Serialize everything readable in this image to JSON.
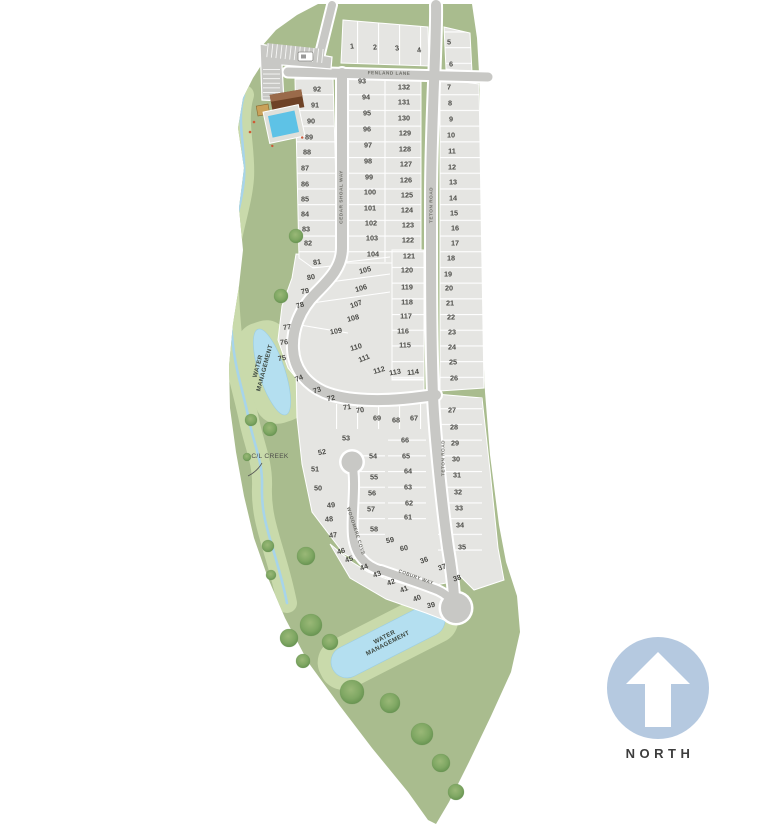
{
  "colors": {
    "land": "#a9bc8e",
    "land_light": "#c9daab",
    "lot": "#e5e5e2",
    "road": "#c8c8c5",
    "water": "#b4dff0",
    "pool": "#5ec2e6",
    "tree": "#7fa763",
    "north_badge": "#b5c9e0",
    "text_dark": "#4b4b47",
    "text_mid": "#6e6e68",
    "clubhouse": "#6e4226"
  },
  "north": {
    "label": "NORTH"
  },
  "map": {
    "streets": [
      {
        "name": "FENLAND LANE",
        "x": 389,
        "y": 73,
        "rot": 1
      },
      {
        "name": "CEDAR SHOAL WAY",
        "x": 341,
        "y": 197,
        "rot": -90
      },
      {
        "name": "TETON ROAD",
        "x": 431,
        "y": 205,
        "rot": -90
      },
      {
        "name": "TETON ROAD",
        "x": 443,
        "y": 458,
        "rot": -90
      },
      {
        "name": "WOODMERE COVE",
        "x": 356,
        "y": 531,
        "rot": 72
      },
      {
        "name": "COBURY WAY",
        "x": 416,
        "y": 577,
        "rot": 20
      }
    ],
    "water_labels": [
      {
        "line1": "WATER",
        "line2": "MANAGEMENT",
        "x": 261,
        "y": 367,
        "rot": -75
      },
      {
        "line1": "WATER",
        "line2": "MANAGEMENT",
        "x": 386,
        "y": 640,
        "rot": -27
      }
    ],
    "creek_label": {
      "name": "C/L CREEK",
      "x": 270,
      "y": 458
    },
    "lots": [
      [
        1,
        352,
        46,
        -6
      ],
      [
        2,
        375,
        47,
        -6
      ],
      [
        3,
        397,
        48,
        -8
      ],
      [
        4,
        419,
        50,
        -8
      ],
      [
        5,
        449,
        42
      ],
      [
        6,
        451,
        64
      ],
      [
        7,
        449,
        87
      ],
      [
        8,
        450,
        103
      ],
      [
        9,
        451,
        119
      ],
      [
        10,
        451,
        135
      ],
      [
        11,
        452,
        151
      ],
      [
        12,
        452,
        167
      ],
      [
        13,
        453,
        182
      ],
      [
        14,
        453,
        198
      ],
      [
        15,
        454,
        213
      ],
      [
        16,
        455,
        228
      ],
      [
        17,
        455,
        243
      ],
      [
        18,
        451,
        258
      ],
      [
        19,
        448,
        274
      ],
      [
        20,
        449,
        288
      ],
      [
        21,
        450,
        303
      ],
      [
        22,
        451,
        317
      ],
      [
        23,
        452,
        332
      ],
      [
        24,
        452,
        347
      ],
      [
        25,
        453,
        362
      ],
      [
        26,
        454,
        378
      ],
      [
        27,
        452,
        410
      ],
      [
        28,
        454,
        427
      ],
      [
        29,
        455,
        443
      ],
      [
        30,
        456,
        459
      ],
      [
        31,
        457,
        475
      ],
      [
        32,
        458,
        492
      ],
      [
        33,
        459,
        508
      ],
      [
        34,
        460,
        525
      ],
      [
        35,
        462,
        547
      ],
      [
        36,
        424,
        560,
        -20
      ],
      [
        37,
        442,
        567,
        -20
      ],
      [
        38,
        457,
        578,
        -18
      ],
      [
        39,
        431,
        605,
        -12
      ],
      [
        40,
        417,
        598,
        -22
      ],
      [
        41,
        404,
        589,
        -22
      ],
      [
        42,
        391,
        582,
        -20
      ],
      [
        43,
        377,
        574,
        -20
      ],
      [
        44,
        364,
        567,
        -20
      ],
      [
        45,
        349,
        559,
        -20
      ],
      [
        46,
        341,
        551,
        -15
      ],
      [
        47,
        333,
        535,
        -8
      ],
      [
        48,
        329,
        519,
        -5
      ],
      [
        49,
        331,
        505,
        -5
      ],
      [
        50,
        318,
        488
      ],
      [
        51,
        315,
        469
      ],
      [
        52,
        322,
        452,
        -10
      ],
      [
        53,
        346,
        438
      ],
      [
        54,
        373,
        456
      ],
      [
        55,
        374,
        477
      ],
      [
        56,
        372,
        493
      ],
      [
        57,
        371,
        509
      ],
      [
        58,
        374,
        529
      ],
      [
        59,
        390,
        540,
        -12
      ],
      [
        60,
        404,
        548,
        -10
      ],
      [
        61,
        408,
        517
      ],
      [
        62,
        409,
        503
      ],
      [
        63,
        408,
        487
      ],
      [
        64,
        408,
        471
      ],
      [
        65,
        406,
        456
      ],
      [
        66,
        405,
        440
      ],
      [
        67,
        414,
        418
      ],
      [
        68,
        396,
        420
      ],
      [
        69,
        377,
        418
      ],
      [
        70,
        360,
        410,
        -8
      ],
      [
        71,
        347,
        407,
        -8
      ],
      [
        72,
        331,
        398,
        -12
      ],
      [
        73,
        317,
        390,
        -18
      ],
      [
        74,
        299,
        378,
        -22
      ],
      [
        75,
        282,
        358,
        -10
      ],
      [
        76,
        284,
        342,
        -5
      ],
      [
        77,
        287,
        327,
        -8
      ],
      [
        78,
        300,
        305,
        -15
      ],
      [
        79,
        305,
        291,
        -12
      ],
      [
        80,
        311,
        277,
        -10
      ],
      [
        81,
        317,
        262,
        -8
      ],
      [
        82,
        308,
        243
      ],
      [
        83,
        306,
        229
      ],
      [
        84,
        305,
        214
      ],
      [
        85,
        305,
        199
      ],
      [
        86,
        305,
        184
      ],
      [
        87,
        305,
        168
      ],
      [
        88,
        307,
        152
      ],
      [
        89,
        309,
        137
      ],
      [
        90,
        311,
        121
      ],
      [
        91,
        315,
        105
      ],
      [
        92,
        317,
        89
      ],
      [
        93,
        362,
        81
      ],
      [
        94,
        366,
        97
      ],
      [
        95,
        367,
        113
      ],
      [
        96,
        367,
        129
      ],
      [
        97,
        368,
        145
      ],
      [
        98,
        368,
        161
      ],
      [
        99,
        369,
        177
      ],
      [
        100,
        370,
        192
      ],
      [
        101,
        370,
        208
      ],
      [
        102,
        371,
        223
      ],
      [
        103,
        372,
        238
      ],
      [
        104,
        373,
        254
      ],
      [
        105,
        365,
        270,
        -14
      ],
      [
        106,
        361,
        288,
        -16
      ],
      [
        107,
        356,
        304,
        -20
      ],
      [
        108,
        353,
        318,
        -14
      ],
      [
        109,
        336,
        331,
        -10
      ],
      [
        110,
        356,
        347,
        -16
      ],
      [
        111,
        364,
        358,
        -22
      ],
      [
        112,
        379,
        370,
        -16
      ],
      [
        113,
        395,
        372,
        -10
      ],
      [
        114,
        413,
        372,
        -6
      ],
      [
        115,
        405,
        345
      ],
      [
        116,
        403,
        331
      ],
      [
        117,
        406,
        316
      ],
      [
        118,
        407,
        302
      ],
      [
        119,
        407,
        287
      ],
      [
        120,
        407,
        270
      ],
      [
        121,
        409,
        256
      ],
      [
        122,
        408,
        240
      ],
      [
        123,
        408,
        225
      ],
      [
        124,
        407,
        210
      ],
      [
        125,
        407,
        195
      ],
      [
        126,
        406,
        180
      ],
      [
        127,
        406,
        164
      ],
      [
        128,
        405,
        149
      ],
      [
        129,
        405,
        133
      ],
      [
        130,
        404,
        118
      ],
      [
        131,
        404,
        102
      ],
      [
        132,
        404,
        87
      ]
    ]
  }
}
